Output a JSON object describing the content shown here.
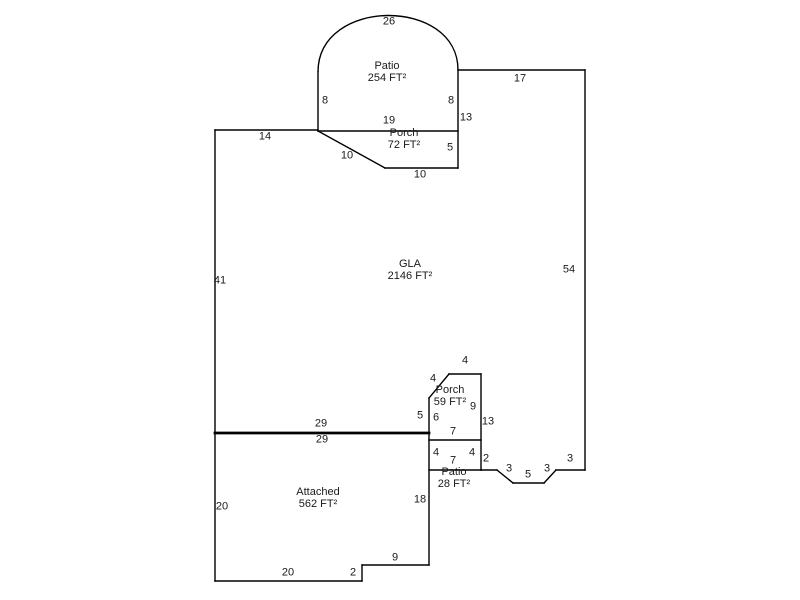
{
  "canvas": {
    "width": 800,
    "height": 600,
    "background_color": "#ffffff",
    "line_color": "#000000",
    "text_color": "#1a1a1a"
  },
  "sketch": {
    "type": "floor-plan-sketch",
    "areas": [
      {
        "name": "Patio",
        "size": "254 FT²",
        "x": 387,
        "y": 66
      },
      {
        "name": "Porch",
        "size": "72 FT²",
        "x": 404,
        "y": 133
      },
      {
        "name": "GLA",
        "size": "2146 FT²",
        "x": 410,
        "y": 264
      },
      {
        "name": "Porch",
        "size": "59 FT²",
        "x": 450,
        "y": 390
      },
      {
        "name": "Patio",
        "size": "28 FT²",
        "x": 454,
        "y": 472
      },
      {
        "name": "Attached",
        "size": "562 FT²",
        "x": 318,
        "y": 492
      }
    ],
    "dimensions": [
      {
        "text": "26",
        "x": 389,
        "y": 22
      },
      {
        "text": "8",
        "x": 325,
        "y": 101
      },
      {
        "text": "8",
        "x": 451,
        "y": 101
      },
      {
        "text": "17",
        "x": 520,
        "y": 79
      },
      {
        "text": "19",
        "x": 389,
        "y": 121
      },
      {
        "text": "13",
        "x": 466,
        "y": 118
      },
      {
        "text": "5",
        "x": 450,
        "y": 148
      },
      {
        "text": "10",
        "x": 347,
        "y": 156
      },
      {
        "text": "10",
        "x": 420,
        "y": 175
      },
      {
        "text": "14",
        "x": 265,
        "y": 137
      },
      {
        "text": "41",
        "x": 220,
        "y": 281
      },
      {
        "text": "54",
        "x": 569,
        "y": 270
      },
      {
        "text": "29",
        "x": 321,
        "y": 424
      },
      {
        "text": "29",
        "x": 322,
        "y": 440
      },
      {
        "text": "4",
        "x": 465,
        "y": 361
      },
      {
        "text": "4",
        "x": 433,
        "y": 379
      },
      {
        "text": "5",
        "x": 420,
        "y": 416
      },
      {
        "text": "6",
        "x": 436,
        "y": 418
      },
      {
        "text": "9",
        "x": 473,
        "y": 407
      },
      {
        "text": "13",
        "x": 488,
        "y": 422
      },
      {
        "text": "7",
        "x": 453,
        "y": 432
      },
      {
        "text": "4",
        "x": 436,
        "y": 453
      },
      {
        "text": "7",
        "x": 453,
        "y": 461
      },
      {
        "text": "4",
        "x": 472,
        "y": 453
      },
      {
        "text": "2",
        "x": 486,
        "y": 459
      },
      {
        "text": "3",
        "x": 509,
        "y": 469
      },
      {
        "text": "5",
        "x": 528,
        "y": 475
      },
      {
        "text": "3",
        "x": 547,
        "y": 469
      },
      {
        "text": "3",
        "x": 570,
        "y": 459
      },
      {
        "text": "18",
        "x": 420,
        "y": 500
      },
      {
        "text": "20",
        "x": 222,
        "y": 507
      },
      {
        "text": "20",
        "x": 288,
        "y": 573
      },
      {
        "text": "2",
        "x": 353,
        "y": 573
      },
      {
        "text": "9",
        "x": 395,
        "y": 558
      }
    ],
    "arc_path": "M 318 72 C 318 -3 458 -3 458 70",
    "segments": [
      {
        "x1": 318,
        "y1": 72,
        "x2": 318,
        "y2": 131
      },
      {
        "x1": 458,
        "y1": 70,
        "x2": 458,
        "y2": 168
      },
      {
        "x1": 318,
        "y1": 131,
        "x2": 458,
        "y2": 131
      },
      {
        "x1": 318,
        "y1": 131,
        "x2": 385,
        "y2": 168
      },
      {
        "x1": 385,
        "y1": 168,
        "x2": 458,
        "y2": 168
      },
      {
        "x1": 458,
        "y1": 70,
        "x2": 585,
        "y2": 70
      },
      {
        "x1": 585,
        "y1": 70,
        "x2": 585,
        "y2": 470
      },
      {
        "x1": 215,
        "y1": 130,
        "x2": 318,
        "y2": 130
      },
      {
        "x1": 215,
        "y1": 130,
        "x2": 215,
        "y2": 581
      },
      {
        "x1": 215,
        "y1": 433,
        "x2": 429,
        "y2": 433,
        "w": 2.8
      },
      {
        "x1": 429,
        "y1": 398,
        "x2": 429,
        "y2": 565
      },
      {
        "x1": 449,
        "y1": 374,
        "x2": 481,
        "y2": 374
      },
      {
        "x1": 449,
        "y1": 374,
        "x2": 429,
        "y2": 398
      },
      {
        "x1": 481,
        "y1": 374,
        "x2": 481,
        "y2": 470
      },
      {
        "x1": 429,
        "y1": 440,
        "x2": 481,
        "y2": 440
      },
      {
        "x1": 429,
        "y1": 470,
        "x2": 481,
        "y2": 470
      },
      {
        "x1": 481,
        "y1": 470,
        "x2": 497,
        "y2": 470
      },
      {
        "x1": 497,
        "y1": 470,
        "x2": 513,
        "y2": 483
      },
      {
        "x1": 513,
        "y1": 483,
        "x2": 544,
        "y2": 483
      },
      {
        "x1": 544,
        "y1": 483,
        "x2": 556,
        "y2": 470
      },
      {
        "x1": 556,
        "y1": 470,
        "x2": 585,
        "y2": 470
      },
      {
        "x1": 215,
        "y1": 581,
        "x2": 362,
        "y2": 581
      },
      {
        "x1": 362,
        "y1": 581,
        "x2": 362,
        "y2": 565
      },
      {
        "x1": 362,
        "y1": 565,
        "x2": 429,
        "y2": 565
      }
    ]
  }
}
